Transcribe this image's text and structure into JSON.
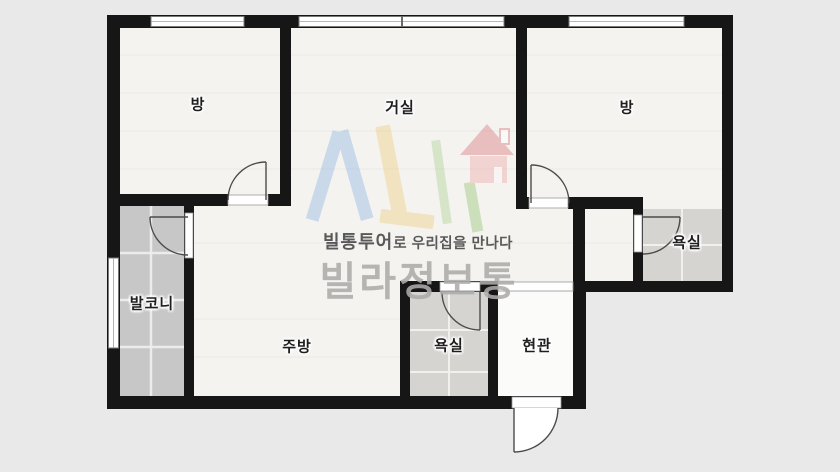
{
  "floorplan": {
    "type": "apartment-floor-plan",
    "rooms": [
      {
        "id": "room-left",
        "label": "방"
      },
      {
        "id": "living-room",
        "label": "거실"
      },
      {
        "id": "room-right",
        "label": "방"
      },
      {
        "id": "bath-right",
        "label": "욕실"
      },
      {
        "id": "balcony",
        "label": "발코니"
      },
      {
        "id": "kitchen",
        "label": "주방"
      },
      {
        "id": "bath-bottom",
        "label": "욕실"
      },
      {
        "id": "entrance",
        "label": "현관"
      }
    ]
  },
  "watermark": {
    "logo_icon": "vl-house-logo",
    "tagline_bold": "빌통투어",
    "tagline_rest": "로 우리집을 만나다",
    "brand": "빌라정보통"
  },
  "colors": {
    "background": "#e9e9e9",
    "wall": "#161616",
    "floor": "#f4f3f0",
    "balcony_tile": "#c7c7c7",
    "bath_tile": "#d6d4d1",
    "entrance_floor": "#fbfbfa",
    "door_line": "#4b4b4b",
    "logo_blue": "#9fc0e6",
    "logo_yellow": "#f0d392",
    "logo_green": "#a3cc87",
    "logo_red": "#dd8d8d",
    "brand_gray": "#aeacaa"
  }
}
